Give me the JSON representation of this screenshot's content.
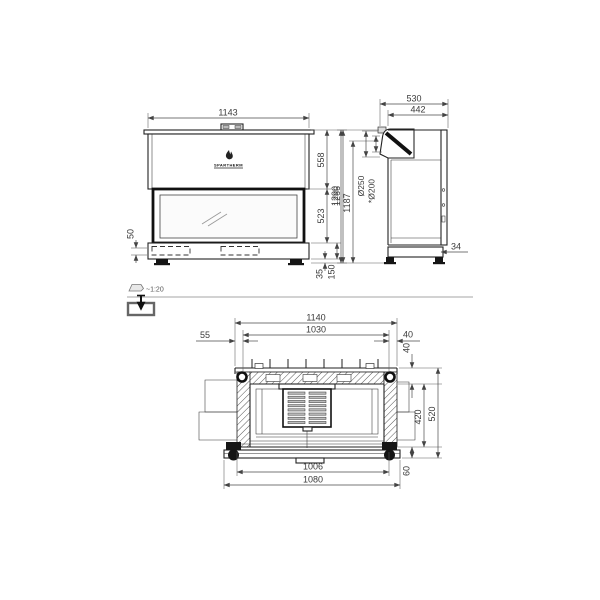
{
  "meta": {
    "brand": "SPARTHERM",
    "scale": "~1:20"
  },
  "front": {
    "width": "1143",
    "hood": "558",
    "glass": "523",
    "total": "1266",
    "plinth": "50",
    "feet": "35",
    "base": "150"
  },
  "side": {
    "depth": "530",
    "body_depth": "442",
    "total": "1290",
    "flue_center": "1187",
    "flue_outer": "Ø250",
    "flue_inner": "*Ø200",
    "base_inset": "34"
  },
  "plan": {
    "top_width": "1140",
    "inner_width": "1030",
    "left_offset": "55",
    "right_offset": "40",
    "back_depth": "40",
    "firebox_depth": "420",
    "total_depth": "520",
    "front_depth": "60",
    "glass_width": "1006",
    "frame_width": "1080"
  }
}
